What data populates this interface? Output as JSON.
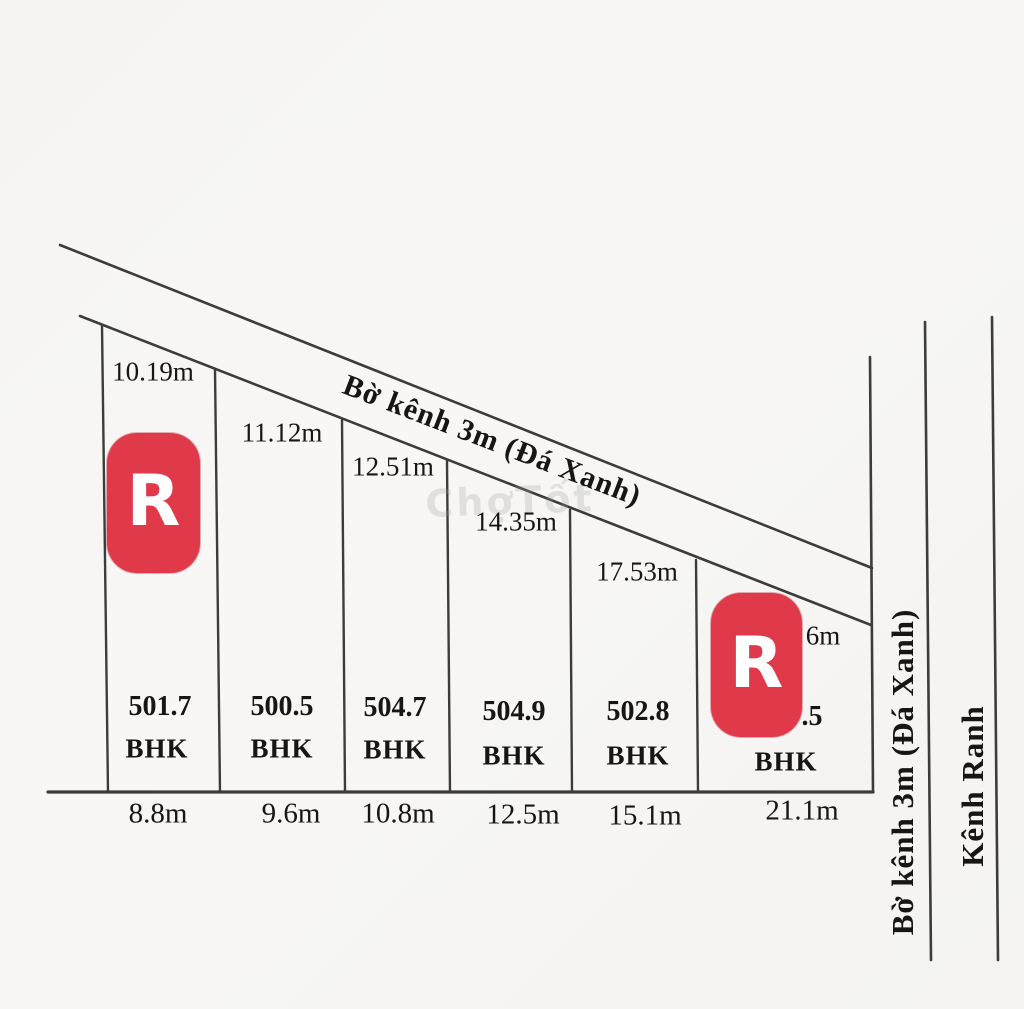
{
  "diagram_title": "Land subdivision sketch",
  "colors": {
    "background": "#f6f5f3",
    "line": "#3c3c3c",
    "badge_red": "#e03a4a",
    "text": "#161616"
  },
  "canal_top": {
    "label": "Bờ kênh 3m (Đá Xanh)"
  },
  "canal_right": {
    "label": "Bờ kênh 3m (Đá Xanh)"
  },
  "kenh_ranh": {
    "label": "Kênh Ranh"
  },
  "watermark": "ChợTốt",
  "logo": {
    "letter": "R"
  },
  "plots": [
    {
      "area": "501.7",
      "land_code": "BHK",
      "frontage": "8.8m",
      "top_edge": "10.19m"
    },
    {
      "area": "500.5",
      "land_code": "BHK",
      "frontage": "9.6m",
      "top_edge": "11.12m"
    },
    {
      "area": "504.7",
      "land_code": "BHK",
      "frontage": "10.8m",
      "top_edge": "12.51m"
    },
    {
      "area": "504.9",
      "land_code": "BHK",
      "frontage": "12.5m",
      "top_edge": "14.35m"
    },
    {
      "area": "502.8",
      "land_code": "BHK",
      "frontage": "15.1m",
      "top_edge": "17.53m"
    },
    {
      "area": ".5",
      "land_code": "BHK",
      "frontage": "21.1m",
      "top_edge": "6m"
    }
  ]
}
